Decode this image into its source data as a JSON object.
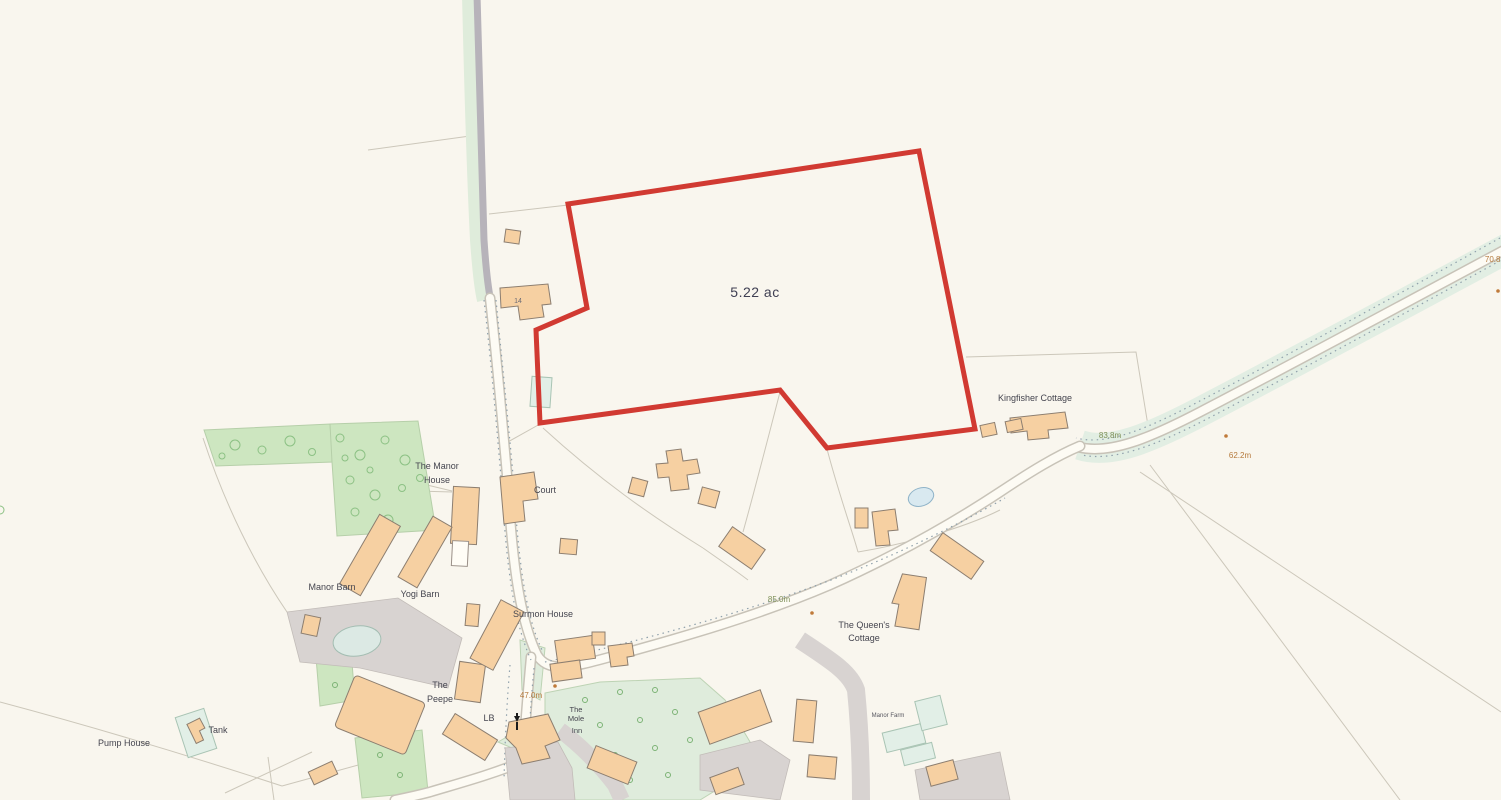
{
  "plot": {
    "area_label": "5.22 ac",
    "boundary_color": "#d13a32"
  },
  "places": {
    "house_14": "14",
    "kingfisher_cottage": "Kingfisher Cottage",
    "manor_house_line1": "The Manor",
    "manor_house_line2": "House",
    "court": "Court",
    "manor_barn": "Manor Barn",
    "yogi_barn": "Yogi Barn",
    "surmon_house": "Surmon House",
    "peepe_line1": "The",
    "peepe_line2": "Peepe",
    "lb": "LB",
    "mole_inn_line1": "The",
    "mole_inn_line2": "Mole",
    "mole_inn_line3": "Inn",
    "queens_cottage_line1": "The Queen's",
    "queens_cottage_line2": "Cottage",
    "manor_farm": "Manor Farm",
    "pump_house": "Pump House",
    "tank": "Tank"
  },
  "spot_heights": {
    "h70_8": "70.8m",
    "h83_8": "83.8m",
    "h62_2": "62.2m",
    "h85_0": "85.0m",
    "h47_0": "47.0m"
  },
  "colors": {
    "background": "#f9f6ee",
    "boundary_red": "#d13a32",
    "building_fill": "#f6d0a2",
    "building_stroke": "#8c7e70",
    "vegetation_green": "#cde6c0",
    "verge_green": "#dfecdb",
    "road_gray": "#b7b3ba",
    "driveway_gray": "#d8d3d1",
    "pond_blue": "#d9e9f0",
    "spot_height_green": "#7d8f56",
    "spot_height_orange": "#b5793b",
    "label_color": "#45454f"
  }
}
